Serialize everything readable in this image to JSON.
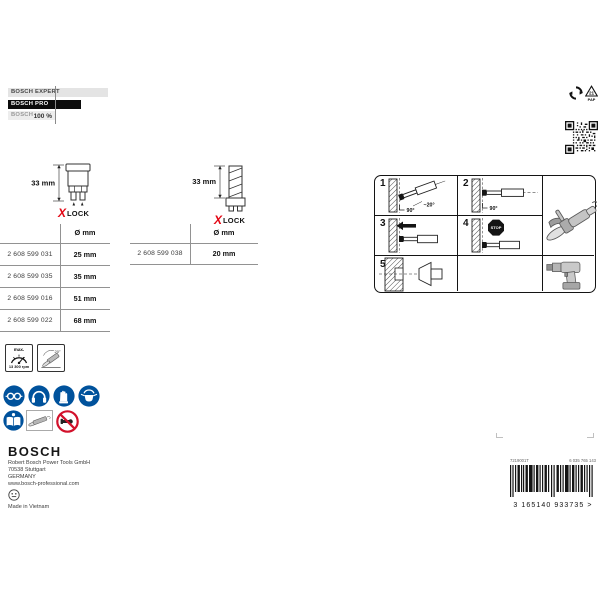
{
  "brand": {
    "expert": "BOSCH EXPERT",
    "pro": "BOSCH PRO",
    "standard": "BOSCH",
    "benchmark": "100 %"
  },
  "recycling": {
    "triangle_number": "21",
    "triangle_code": "PAP"
  },
  "products": [
    {
      "length_label": "33 mm",
      "xlock_x": "X",
      "xlock_lock": "LOCK",
      "table": {
        "diameter_header": "Ø mm",
        "rows": [
          {
            "sku": "2 608 599 031",
            "diameter": "25 mm"
          },
          {
            "sku": "2 608 599 035",
            "diameter": "35 mm"
          },
          {
            "sku": "2 608 599 016",
            "diameter": "51 mm"
          },
          {
            "sku": "2 608 599 022",
            "diameter": "68 mm"
          }
        ]
      }
    },
    {
      "length_label": "33 mm",
      "xlock_x": "X",
      "xlock_lock": "LOCK",
      "table": {
        "diameter_header": "Ø mm",
        "rows": [
          {
            "sku": "2 608 599 038",
            "diameter": "20 mm"
          }
        ]
      }
    }
  ],
  "instructions": {
    "step1": {
      "num": "1",
      "approach_angle": "~20°",
      "base_angle": "90°"
    },
    "step2": {
      "num": "2",
      "base_angle": "90°"
    },
    "step3": {
      "num": "3"
    },
    "step4": {
      "num": "4",
      "stop_label": "STOP"
    },
    "step5": {
      "num": "5"
    },
    "tools": [
      "angle-grinder",
      "cordless-drill"
    ]
  },
  "safety": {
    "max_speed": {
      "prefix": "max.",
      "value": "13 300 rpm"
    },
    "grinder_angle": "20°",
    "mandatory_icons": [
      "eye-protection",
      "ear-protection",
      "hand-protection",
      "respiratory-protection",
      "read-instructions"
    ],
    "other_icons": [
      "angle-grinder-thumbnail",
      "no-handheld-prohibition"
    ]
  },
  "footer": {
    "brand": "BOSCH",
    "address_line1": "Robert Bosch Power Tools GmbH",
    "address_line2": "70538 Stuttgart",
    "address_line3": "GERMANY",
    "website": "www.bosch-professional.com",
    "made_in": "Made in Vietnam"
  },
  "barcode": {
    "left_code": "7219001T",
    "right_code": "6 035 765 143",
    "ean": "3 165140 933735 >"
  }
}
